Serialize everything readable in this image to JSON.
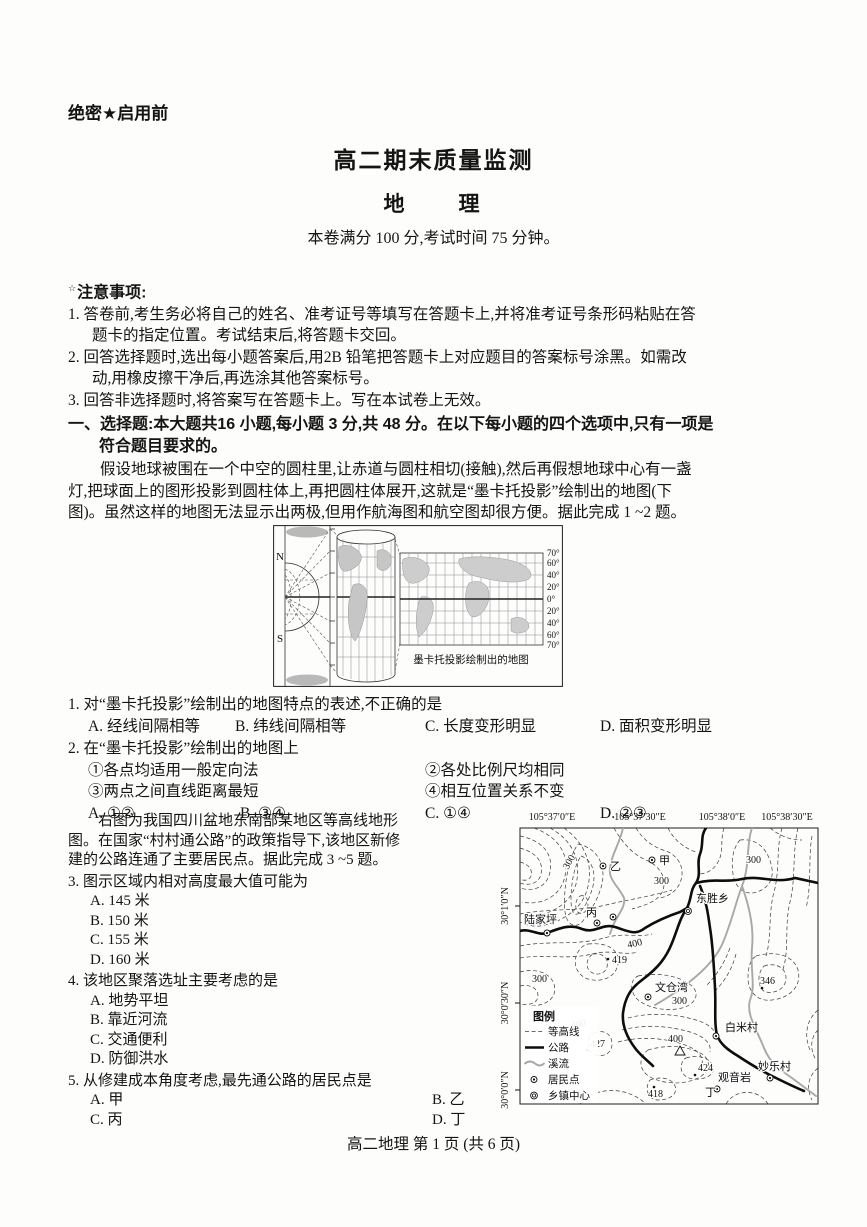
{
  "header": {
    "classification": "绝密★启用前",
    "title": "高二期末质量监测",
    "subject": "地　　理",
    "info": "本卷满分 100 分,考试时间 75 分钟。"
  },
  "notes": {
    "star": "☆",
    "heading": "注意事项:",
    "lines": [
      "1. 答卷前,考生务必将自己的姓名、准考证号等填写在答题卡上,并将准考证号条形码粘贴在答",
      "题卡的指定位置。考试结束后,将答题卡交回。",
      "2. 回答选择题时,选出每小题答案后,用2B 铅笔把答题卡上对应题目的答案标号涂黑。如需改",
      "动,用橡皮擦干净后,再选涂其他答案标号。",
      "3. 回答非选择题时,将答案写在答题卡上。写在本试卷上无效。"
    ]
  },
  "section": {
    "lines": [
      "一、选择题:本大题共16 小题,每小题 3 分,共 48 分。在以下每小题的四个选项中,只有一项是",
      "符合题目要求的。"
    ]
  },
  "passage1": {
    "lines": [
      "假设地球被围在一个中空的圆柱里,让赤道与圆柱相切(接触),然后再假想地球中心有一盏",
      "灯,把球面上的图形投影到圆柱体上,再把圆柱体展开,这就是“墨卡托投影”绘制出的地图(下",
      "图)。虽然这样的地图无法显示出两极,但用作航海图和航空图却很方便。据此完成 1 ~2 题。"
    ]
  },
  "figure1": {
    "north": "N",
    "south": "S",
    "lat_labels": [
      "70°",
      "60°",
      "40°",
      "20°",
      "0°",
      "20°",
      "40°",
      "60°",
      "70°"
    ],
    "caption": "墨卡托投影绘制出的地图"
  },
  "q1": {
    "stem": "1. 对“墨卡托投影”绘制出的地图特点的表述,不正确的是",
    "options": [
      "A. 经线间隔相等",
      "B. 纬线间隔相等",
      "C. 长度变形明显",
      "D. 面积变形明显"
    ]
  },
  "q2": {
    "stem": "2. 在“墨卡托投影”绘制出的地图上",
    "statements": [
      "①各点均适用一般定向法",
      "②各处比例尺均相同",
      "③两点之间直线距离最短",
      "④相互位置关系不变"
    ],
    "options": [
      "A. ①②",
      "B. ③④",
      "C. ①④",
      "D. ②③"
    ]
  },
  "passage2": {
    "lines": [
      "右图为我国四川盆地东南部某地区等高线地形",
      "图。在国家“村村通公路”的政策指导下,该地区新修",
      "建的公路连通了主要居民点。据此完成 3 ~5 题。"
    ]
  },
  "q3": {
    "stem": "3. 图示区域内相对高度最大值可能为",
    "options": [
      "A. 145 米",
      "B. 150 米",
      "C. 155 米",
      "D. 160 米"
    ]
  },
  "q4": {
    "stem": "4. 该地区聚落选址主要考虑的是",
    "options": [
      "A. 地势平坦",
      "B. 靠近河流",
      "C. 交通便利",
      "D. 防御洪水"
    ]
  },
  "q5": {
    "stem": "5. 从修建成本角度考虑,最先通公路的居民点是",
    "options": [
      "A. 甲",
      "B. 乙",
      "C. 丙",
      "D. 丁"
    ]
  },
  "map": {
    "lon_labels": [
      "105°37′0″E",
      "105°37′30″E",
      "105°38′0″E",
      "105°38′30″E"
    ],
    "lat_labels": [
      "30°1′0″N",
      "30°0′30″N",
      "30°0′0″N"
    ],
    "places": {
      "jia": "甲",
      "yi": "乙",
      "bing": "丙",
      "ding": "丁",
      "dongsheng": "东胜乡",
      "lujiaping": "陆家坪",
      "wencangwan": "文仓湾",
      "baimicun": "白米村",
      "miaolecun": "妙乐村",
      "guanyinyan": "观音岩"
    },
    "contour_labels": {
      "c300": "300",
      "c400": "400"
    },
    "spot_heights": {
      "h419": "419",
      "h427": "427",
      "h424": "424",
      "h418": "418",
      "h346": "346"
    },
    "legend": {
      "title": "图例",
      "contour": "等高线",
      "road": "公路",
      "stream": "溪流",
      "settlement": "居民点",
      "township": "乡镇中心"
    }
  },
  "footer": "高二地理 第 1 页 (共 6 页)"
}
